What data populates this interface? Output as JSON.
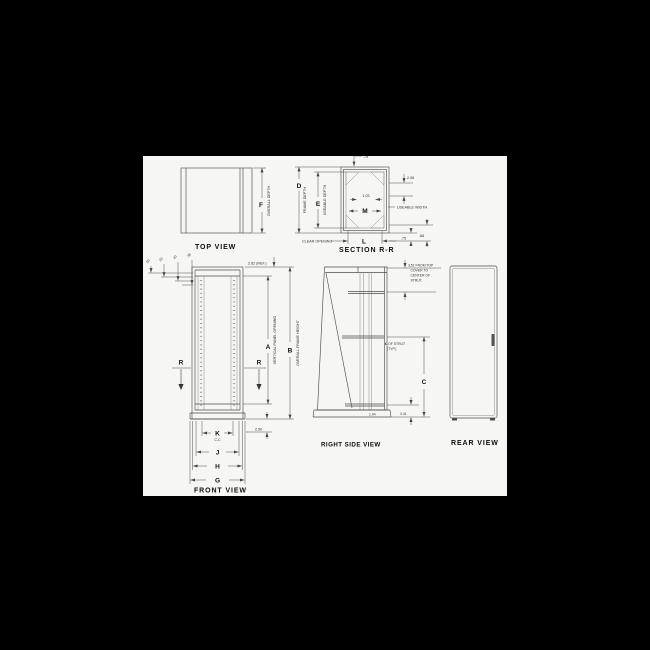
{
  "colors": {
    "background": "#000000",
    "paper": "#f6f6f4",
    "line": "#4d4d4d",
    "text": "#1a1a1a"
  },
  "views": {
    "top": {
      "label": "TOP VIEW",
      "f": "F",
      "overall_depth": "OVERALL DEPTH"
    },
    "section": {
      "label": "SECTION R-R",
      "d": "D",
      "frame_depth": "FRAME DEPTH",
      "e": "E",
      "useable_depth": "USEABLE DEPTH",
      "m": "M",
      "useable_width": "USEABLE WIDTH",
      "clear_opening": "CLEAR OPENING",
      "l": "L",
      "v103": "1.03",
      "v75": ".75",
      "v208": "2.08",
      "v88": ".88"
    },
    "front": {
      "label": "FRONT VIEW",
      "a": "A",
      "vertical_panel_opening": "VERTICAL PANEL OPENING",
      "b": "B",
      "overall_frame_height": "OVERALL FRAME HEIGHT",
      "ref262": "2.62 (REF.)",
      "c50": ".50",
      "c63": ".63",
      "c43": ".43",
      "c38": ".38",
      "r": "R",
      "k": "K",
      "cc": "C-C",
      "j": "J",
      "h": "H",
      "g": "G",
      "v250": "2.50"
    },
    "side": {
      "label": "RIGHT SIDE VIEW",
      "note1": "3.51 FROM TOP",
      "note2": "COVER TO",
      "note3": "CENTER OF",
      "note4": "STRUT.",
      "strut1": "℄ OF STRUT",
      "strut2": "(TYP.)",
      "c": "C",
      "v341": "3.41",
      "v104": "1.04"
    },
    "rear": {
      "label": "REAR VIEW"
    }
  }
}
